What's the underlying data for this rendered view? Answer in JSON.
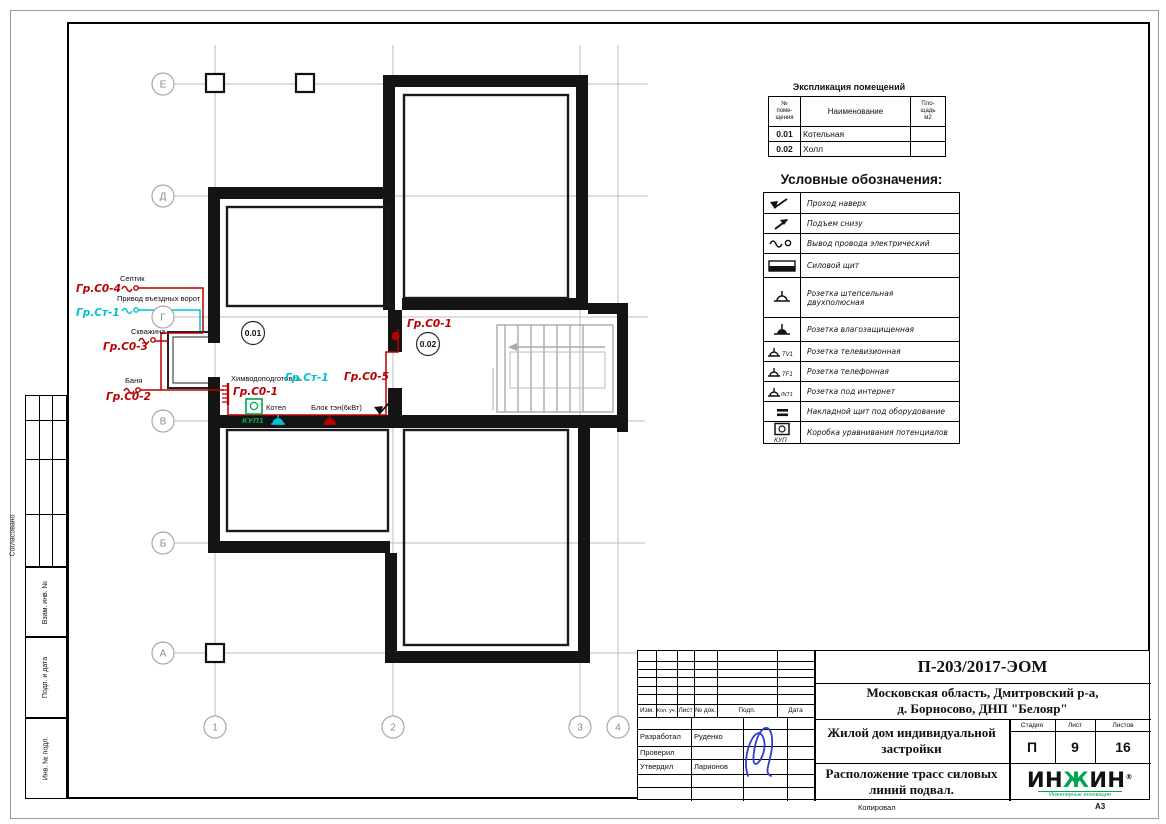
{
  "sheet": {
    "copied_label": "Копировал",
    "format": "А3"
  },
  "side_stamps": {
    "agreed": "Согласовано",
    "subst_inv": "Взам. инв. №",
    "sign_date": "Подп. и дата",
    "inv_orig": "Инв. № подл."
  },
  "explication": {
    "title": "Экспликация помещений",
    "col_num": "№\nпоме-\nщения",
    "col_name": "Наименование",
    "col_area": "Пло-\nщадь\nм2",
    "rows": [
      {
        "num": "0.01",
        "name": "Котельная",
        "area": ""
      },
      {
        "num": "0.02",
        "name": "Холл",
        "area": ""
      }
    ]
  },
  "legend": {
    "title": "Условные обозначения:",
    "items": [
      {
        "icon": "passage-up-icon",
        "label": "Проход наверх"
      },
      {
        "icon": "rise-from-below-icon",
        "label": "Подъем снизу"
      },
      {
        "icon": "wire-outlet-icon",
        "label": "Вывод провода электрический"
      },
      {
        "icon": "power-panel-icon",
        "label": "Силовой щит"
      },
      {
        "icon": "socket-two-pole-icon",
        "label": "Розетка штепсельная\nдвухполюсная"
      },
      {
        "icon": "socket-moistureproof-icon",
        "label": "Розетка влагозащищенная"
      },
      {
        "icon": "socket-tv-icon",
        "tag": "TV1",
        "label": "Розетка телевизионная"
      },
      {
        "icon": "socket-phone-icon",
        "tag": "TF1",
        "label": "Розетка телефонная"
      },
      {
        "icon": "socket-internet-icon",
        "tag": "INT1",
        "label": "Розетка под интернет"
      },
      {
        "icon": "surface-panel-icon",
        "label": "Накладной щит под оборудование"
      },
      {
        "icon": "potential-box-icon",
        "tag": "КУП",
        "label": "Коробка уравнивания потенциалов"
      }
    ]
  },
  "plan": {
    "grid_rows": [
      "Е",
      "Д",
      "Г",
      "В",
      "Б",
      "А"
    ],
    "grid_cols": [
      "1",
      "2",
      "3",
      "4"
    ],
    "room_tags": [
      "0.01",
      "0.02"
    ],
    "devices": [
      {
        "label": "Септик",
        "group": "Гр.С0-4"
      },
      {
        "label": "Привод въездных ворот",
        "group": "Гр.Ст-1"
      },
      {
        "label": "Скважина",
        "group": "Гр.С0-3"
      },
      {
        "label": "Баня",
        "group": "Гр.С0-2"
      }
    ],
    "boiler": {
      "water_treatment": "Химводоподготовка",
      "panel_group": "Гр.С0-1",
      "kup": "КУП1",
      "boiler_label": "Котел",
      "boiler_group": "Гр.Ст-1",
      "ten_label": "Блок тэн(6кВт)",
      "ten_group": "Гр.С0-5",
      "riser_group": "Гр.С0-1"
    }
  },
  "titleblock": {
    "doc_number": "П-203/2017-ЭОМ",
    "address": "Московская область, Дмитровский р-а,\nд. Борносово, ДНП \"Белояр\"",
    "object_title": "Жилой дом индивидуальной\nзастройки",
    "sheet_title": "Расположение трасс силовых\nлиний подвал.",
    "cols": {
      "izm": "Изм.",
      "kol": "Кол. уч.",
      "list": "Лист",
      "doc": "№ док.",
      "podp": "Подп.",
      "data": "Дата"
    },
    "roles": {
      "developed": "Разработал",
      "developed_name": "Руденко",
      "checked": "Проверил",
      "approved": "Утвердил",
      "approved_name": "Ларионов"
    },
    "stage_label": "Стадия",
    "sheet_label": "Лист",
    "sheets_label": "Листов",
    "stage": "П",
    "sheet_num": "9",
    "sheets_total": "16",
    "logo_p1": "ИН",
    "logo_p2": "Ж",
    "logo_p3": "ИН",
    "logo_reg": "®",
    "logo_sub": "Инженерные инновации"
  },
  "colors": {
    "wire_red": "#b80000",
    "wire_cyan": "#00c2d4",
    "green": "#00a651",
    "signature_blue": "#2b3fd0"
  }
}
